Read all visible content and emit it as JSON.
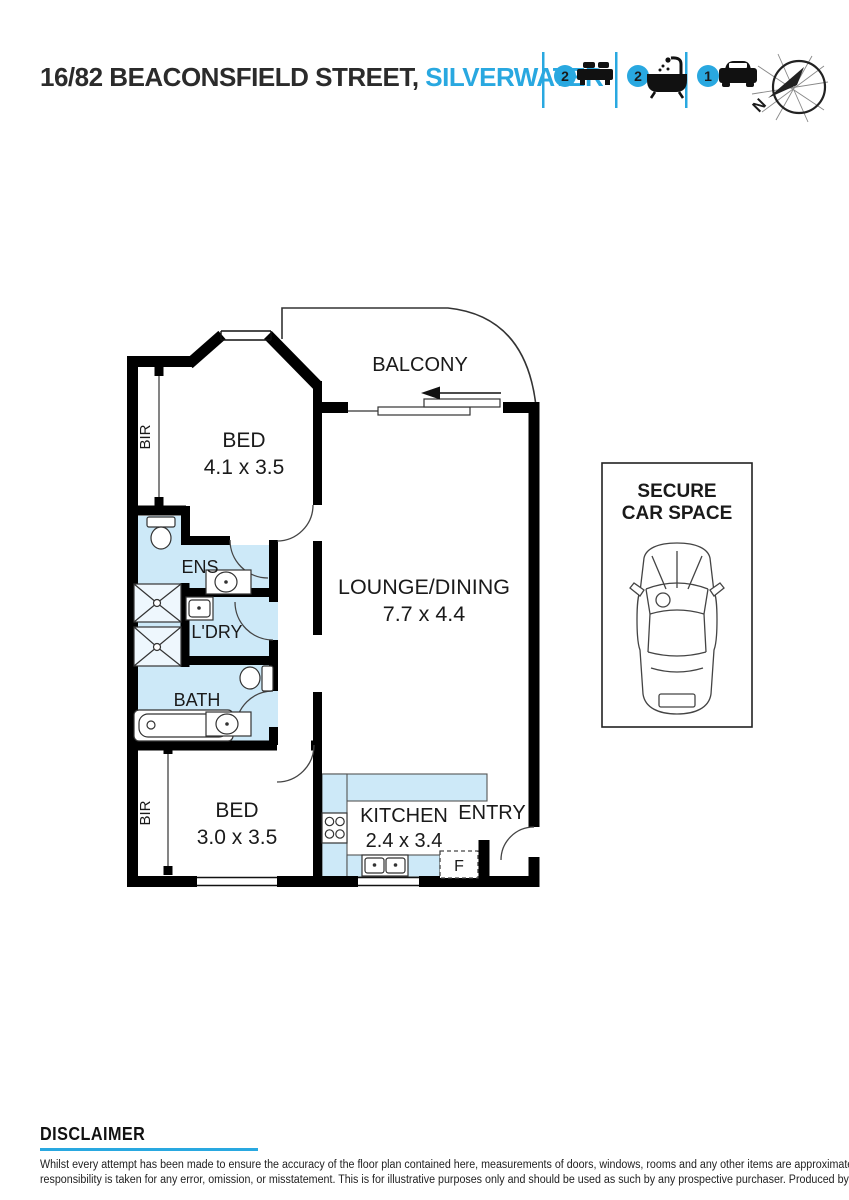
{
  "header": {
    "address_main": "16/82 BEACONSFIELD STREET,",
    "address_suburb": "SILVERWATER",
    "stats": [
      {
        "icon": "bed-icon",
        "count": "2"
      },
      {
        "icon": "bath-icon",
        "count": "2"
      },
      {
        "icon": "car-icon",
        "count": "1"
      }
    ],
    "compass_label": "N"
  },
  "colors": {
    "accent": "#29a8e0",
    "wet_area_fill": "#cde9f8",
    "wall": "#000000"
  },
  "plan": {
    "balcony": "BALCONY",
    "bed1": {
      "name": "BED",
      "dims": "4.1 x 3.5"
    },
    "lounge": {
      "name": "LOUNGE/DINING",
      "dims": "7.7 x 4.4"
    },
    "ens": "ENS",
    "ldry": "L'DRY",
    "bath": "BATH",
    "bed2": {
      "name": "BED",
      "dims": "3.0 x 3.5"
    },
    "kitchen": {
      "name": "KITCHEN",
      "dims": "2.4 x 3.4"
    },
    "entry": "ENTRY",
    "fridge": "F",
    "bir_top": "BIR",
    "bir_bottom": "BIR"
  },
  "car_space": {
    "line1": "SECURE",
    "line2": "CAR SPACE"
  },
  "disclaimer": {
    "heading": "DISCLAIMER",
    "line1": "Whilst every attempt has been made to ensure the accuracy of the floor plan contained here, measurements of doors, windows, rooms and any other items are approximate and no",
    "line2": "responsibility is taken for any error, omission, or misstatement. This is for illustrative purposes only and should be used as such by any prospective purchaser. Produced by VIBEO"
  }
}
